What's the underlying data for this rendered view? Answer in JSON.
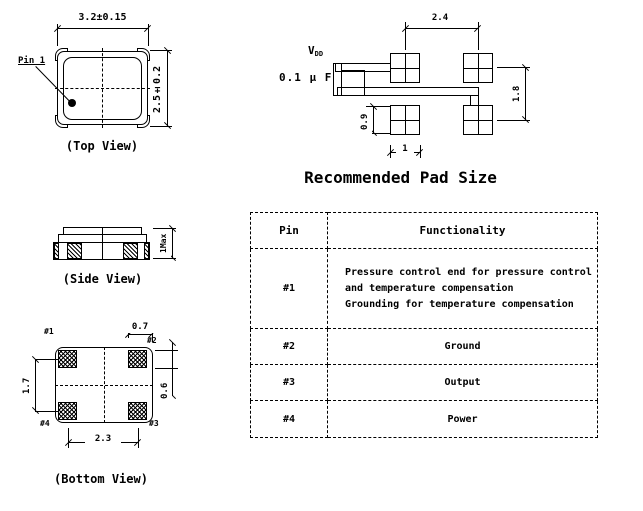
{
  "colors": {
    "ink": "#000000",
    "paper": "#ffffff"
  },
  "top_view": {
    "caption": "(Top View)",
    "pin1_label": "Pin 1",
    "dim_width": "3.2±0.15",
    "dim_height": "2.5±0.2"
  },
  "side_view": {
    "caption": "(Side View)",
    "dim_height": "1Max"
  },
  "bottom_view": {
    "caption": "(Bottom View)",
    "pad_labels": {
      "p1": "#1",
      "p2": "#2",
      "p3": "#3",
      "p4": "#4"
    },
    "dim_pad_width": "0.7",
    "dim_pad_pitch_v": "1.7",
    "dim_pad_height": "0.6",
    "dim_pad_pitch_h": "2.3"
  },
  "pad_layout": {
    "caption": "Recommended Pad Size",
    "vdd_label": "V",
    "vdd_subscript": "DD",
    "capacitor_label": "0.1 µ F",
    "dim_pitch_h": "2.4",
    "dim_pitch_v": "1.8",
    "dim_pad_h": "0.9",
    "dim_pad_w": "1"
  },
  "pin_table": {
    "headers": {
      "pin": "Pin",
      "functionality": "Functionality"
    },
    "rows": [
      {
        "pin": "#1",
        "lines": [
          "Pressure control end for pressure control",
          "and temperature compensation",
          "Grounding for temperature compensation"
        ]
      },
      {
        "pin": "#2",
        "lines": [
          "Ground"
        ]
      },
      {
        "pin": "#3",
        "lines": [
          "Output"
        ]
      },
      {
        "pin": "#4",
        "lines": [
          "Power"
        ]
      }
    ]
  }
}
